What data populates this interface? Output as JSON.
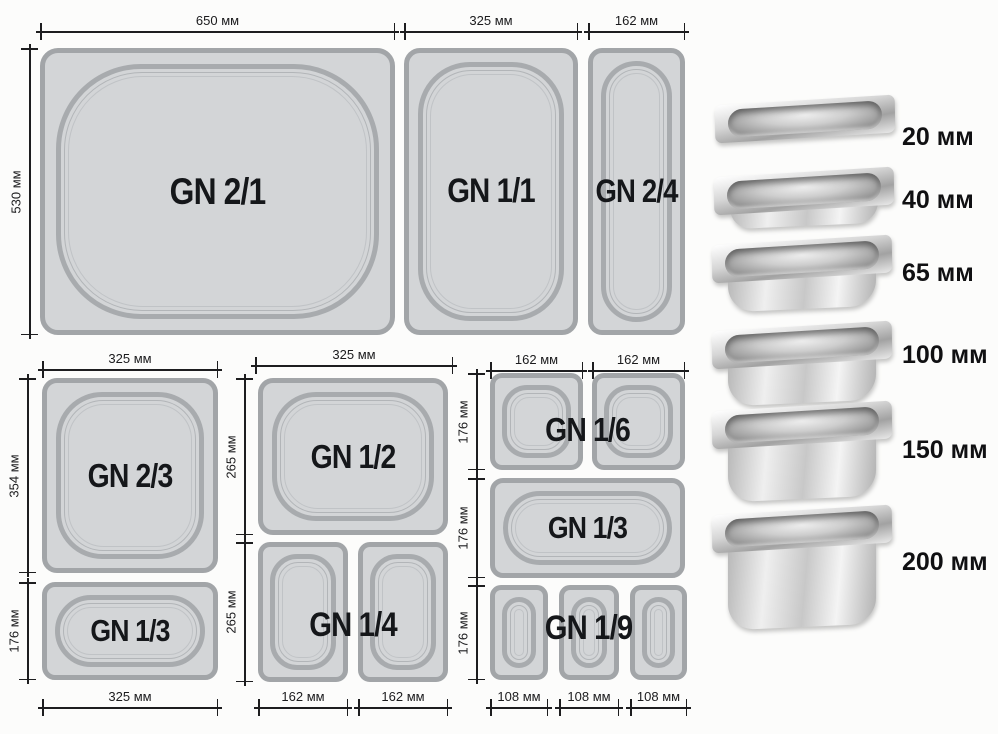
{
  "colors": {
    "pan_fill": "#d3d5d7",
    "pan_border": "#a2a5a8",
    "dimension_line": "#1d1d1f",
    "label_text": "#15171a",
    "background": "#fcfcfb"
  },
  "pans": {
    "gn21": {
      "label": "GN 2/1"
    },
    "gn11": {
      "label": "GN 1/1"
    },
    "gn24": {
      "label": "GN 2/4"
    },
    "gn23": {
      "label": "GN 2/3"
    },
    "gn13_left": {
      "label": "GN 1/3"
    },
    "gn12": {
      "label": "GN 1/2"
    },
    "gn14": {
      "label": "GN 1/4"
    },
    "gn16": {
      "label": "GN 1/6"
    },
    "gn13_right": {
      "label": "GN 1/3"
    },
    "gn19": {
      "label": "GN 1/9"
    }
  },
  "dimensions": {
    "gn21_width": "650 мм",
    "gn21_height": "530 мм",
    "gn11_width": "325 мм",
    "gn24_width": "162 мм",
    "gn23_width": "325 мм",
    "gn23_height": "354 мм",
    "gn13_left_height": "176 мм",
    "gn13_left_width": "325 мм",
    "gn12_width": "325 мм",
    "gn12_height": "265 мм",
    "gn14_height": "265 мм",
    "gn14_width_left": "162 мм",
    "gn14_width_right": "162 мм",
    "gn16_width_left": "162 мм",
    "gn16_width_right": "162 мм",
    "gn16_height": "176 мм",
    "gn13_right_height": "176 мм",
    "gn19_height": "176 мм",
    "gn19_width_1": "108 мм",
    "gn19_width_2": "108 мм",
    "gn19_width_3": "108 мм"
  },
  "depths": {
    "items": [
      {
        "label": "20 мм"
      },
      {
        "label": "40 мм"
      },
      {
        "label": "65 мм"
      },
      {
        "label": "100 мм"
      },
      {
        "label": "150 мм"
      },
      {
        "label": "200 мм"
      }
    ]
  }
}
